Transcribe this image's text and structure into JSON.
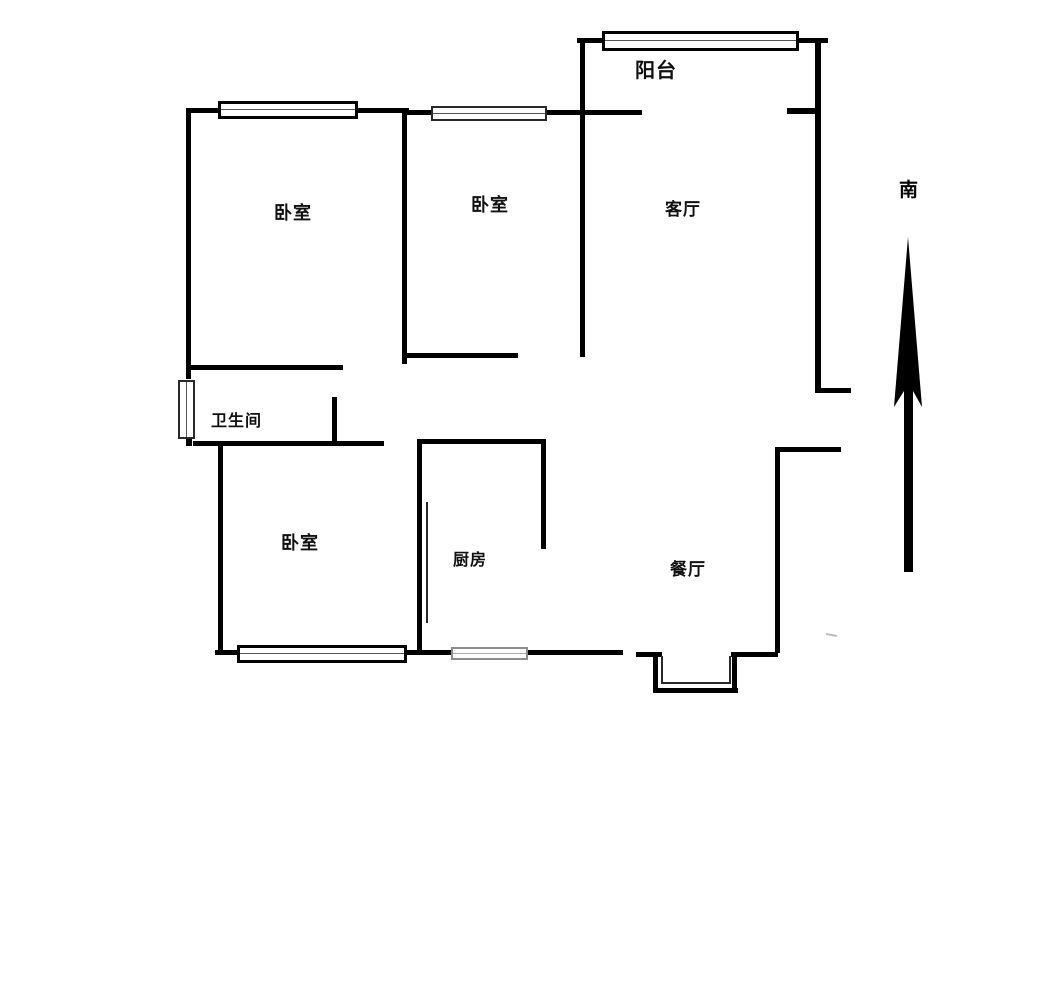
{
  "plan": {
    "kind": "apartment floor plan",
    "labels": {
      "balcony": "阳台",
      "bedroom_nw": "卧室",
      "bedroom_n": "卧室",
      "living_room": "客厅",
      "bathroom": "卫生间",
      "bedroom_sw": "卧室",
      "kitchen": "厨房",
      "dining_room": "餐厅",
      "compass_south": "南"
    },
    "colors": {
      "background": "#ffffff",
      "wall": "#000000",
      "window_frame": "#000000",
      "window_frame_light": "#8d8d8d",
      "text": "#111111"
    }
  }
}
